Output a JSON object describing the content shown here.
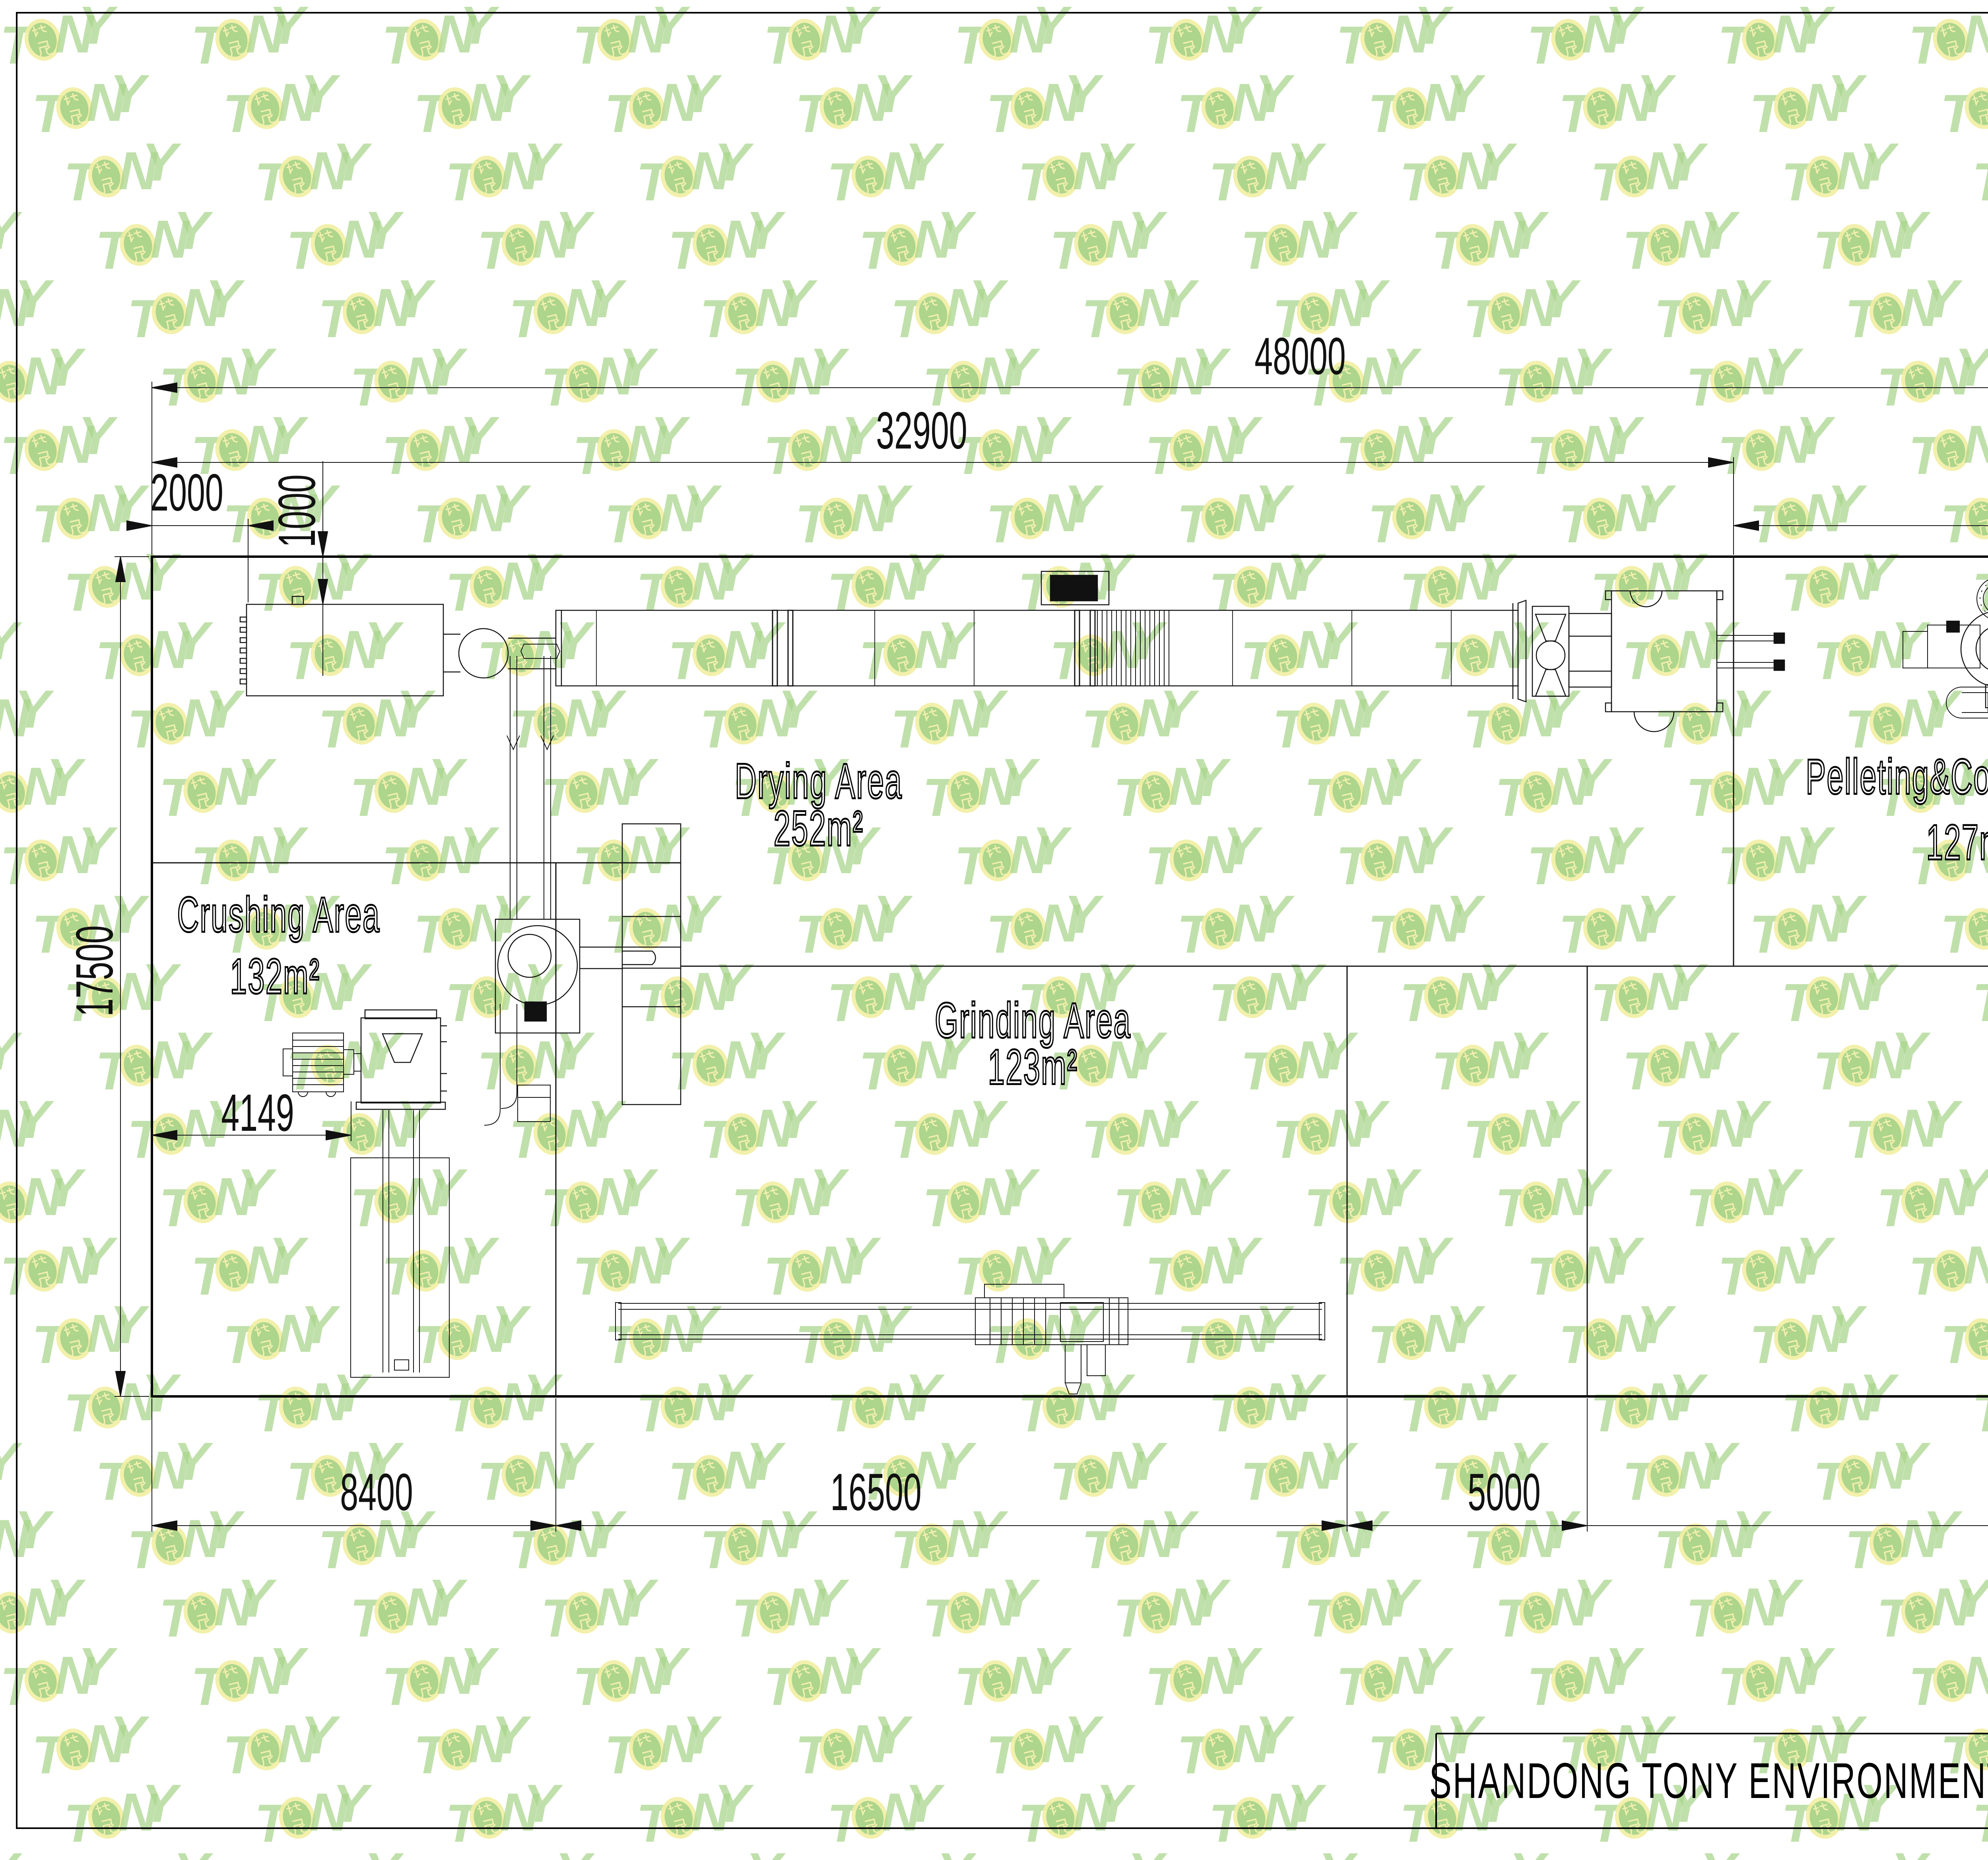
{
  "sheet": {
    "background": "#ffffff",
    "line_color": "#111111",
    "wall_color": "#000000"
  },
  "watermark": {
    "letters": [
      "T",
      "O",
      "N",
      "Y"
    ],
    "badge_text": "托尼",
    "letter_color": "#a8d48a",
    "badge_ring_color": "#f1efa2",
    "badge_fill_color": "#a9d48b",
    "badge_text_color": "#f2efad"
  },
  "title_block": {
    "company": "SHANDONG TONY ENVIRONMENTAL PROTECTION SCI-TECH CO.,LTD"
  },
  "areas": {
    "crushing": {
      "name": "Crushing Area",
      "size": "132m²"
    },
    "drying": {
      "name": "Drying Area",
      "size": "252m²"
    },
    "grinding": {
      "name": "Grinding Area",
      "size": "123m²"
    },
    "pelleting": {
      "name": "Pelleting&Cooling Area",
      "size": "127m²"
    },
    "packing": {
      "name": "Packing Area",
      "size": "163m²"
    }
  },
  "dimensions": {
    "overall_width": "48000",
    "drying_span": "32900",
    "pelleting_span": "15100",
    "left_inset": "2000",
    "drum_inset": "1000",
    "overall_depth": "17500",
    "pelleting_depth": "8500",
    "packing_depth": "9000",
    "packing_inset": "1067",
    "crusher_span": "4149",
    "crushing_width": "8400",
    "grinding_width": "16500",
    "corridor_width": "5000",
    "packing_width": "18100"
  }
}
